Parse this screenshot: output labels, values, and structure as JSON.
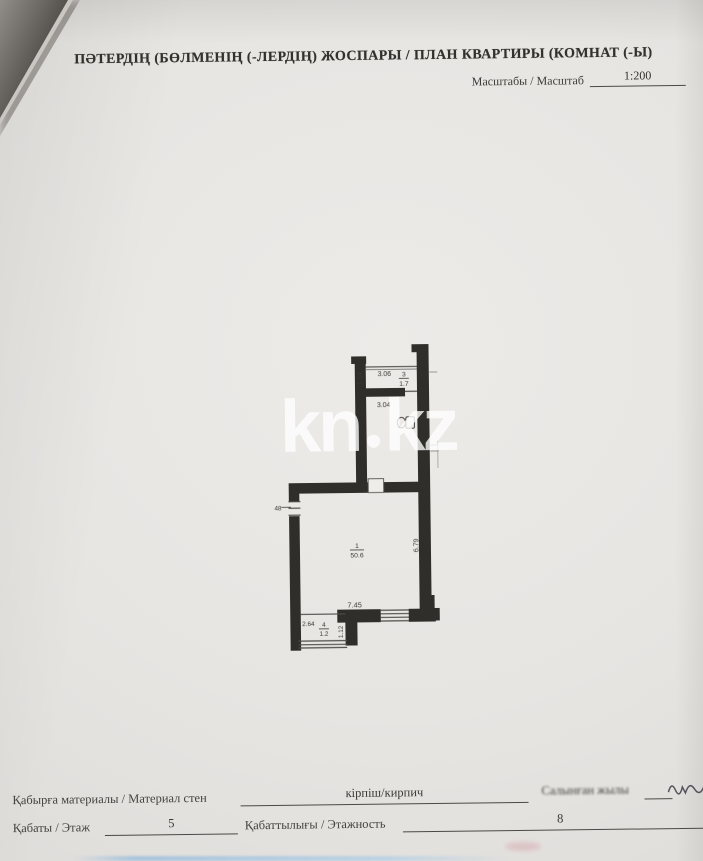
{
  "document": {
    "title": "ПӘТЕРДІҢ (БӨЛМЕНІҢ (-ЛЕРДІҢ) ЖОСПАРЫ / ПЛАН КВАРТИРЫ (КОМНАТ (-Ы)",
    "scale_label": "Масштабы / Масштаб",
    "scale_value": "1:200"
  },
  "watermark": {
    "part1": "kn",
    "part2": "kz"
  },
  "plan": {
    "rooms": [
      {
        "number": "3",
        "area": "1.7"
      },
      {
        "number": "1",
        "area": "50.6"
      },
      {
        "number": "4",
        "area": "1.2"
      }
    ],
    "dimensions": {
      "room3_width": "3.06",
      "room3_height": "1.14",
      "corridor_width": "3.04",
      "main_room_height": "6.79",
      "main_room_width": "7.45",
      "room4_width": "2.64",
      "room4_height": "1.12",
      "window_mark": "48"
    }
  },
  "footer": {
    "wall_material_label": "Қабырға материалы / Материал стен",
    "wall_material_value": "кірпіш/кирпич",
    "built_year_label": "Салынған жылы",
    "floor_label": "Қабаты / Этаж",
    "floor_value": "5",
    "total_floors_label": "Қабаттылығы / Этажность",
    "total_floors_value": "8"
  }
}
